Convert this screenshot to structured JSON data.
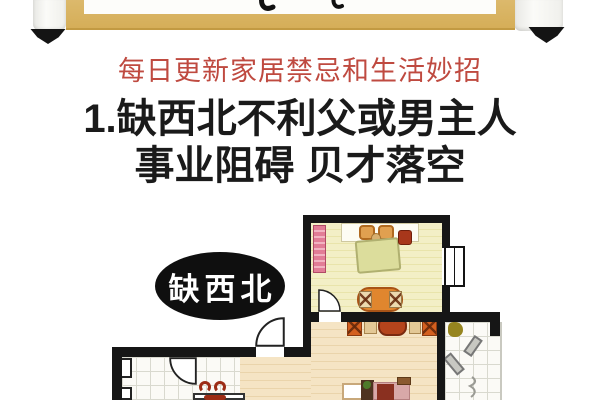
{
  "banner": {
    "subtitle": "每日更新家居禁忌和生活妙招"
  },
  "article": {
    "title_line1": "1.缺西北不利父或男主人",
    "title_line2": "事业阻碍 贝才落空"
  },
  "floorplan": {
    "label": "缺西北"
  },
  "colors": {
    "wall": "#161616",
    "gold": "#d9b364",
    "subtitle-red": "#bf4a40",
    "title-black": "#1a1a1a",
    "bedroom-floor": "#f3efc6",
    "living-floor": "#f5e4c4",
    "tile": "#fbfaf6",
    "label-bg": "#0f0f0f",
    "label-text": "#ffffff",
    "sofa-orange": "#e0862e",
    "chair-orange": "#d4601f",
    "table-red": "#b4441c",
    "blanket-green": "#dcdd9c",
    "wardrobe-pink": "#e27d96"
  }
}
